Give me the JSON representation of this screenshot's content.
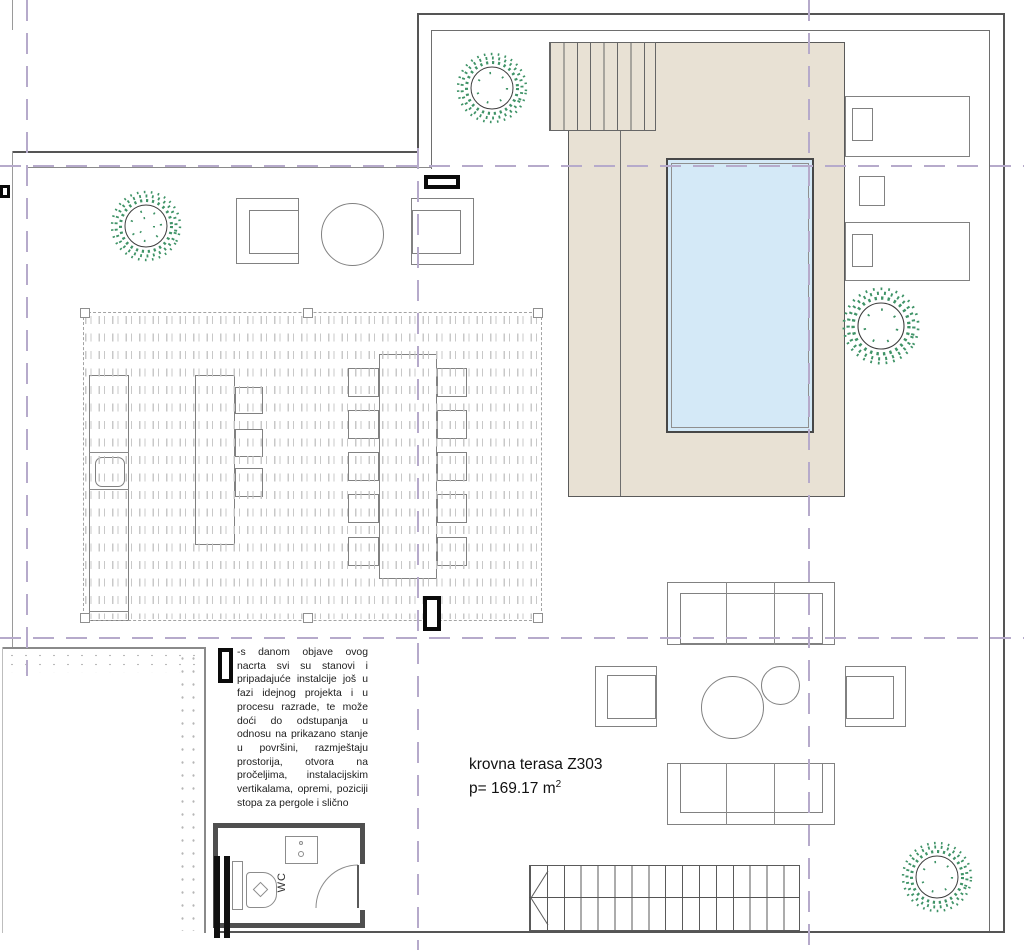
{
  "labels": {
    "room_title": "krovna terasa Z303",
    "room_area": "p= 169.17 m",
    "room_area_sup": "2",
    "wc": "WC",
    "note": "-s danom objave ovog nacrta svi su stanovi i pripadajuće instalcije još u fazi idejnog projekta i u procesu razrade, te može doći do odstupanja u odnosu na prikazano stanje u površini, razmještaju prostorija, otvora na pročeljima, instalacijskim vertikalama, opremi, poziciji stopa za pergole i slično"
  },
  "colors": {
    "deck": "#e8e1d4",
    "pool": "#d4e9f7",
    "axis": "#b6aacb",
    "line": "#555555",
    "line_light": "#8a8a8a",
    "tree": "#3f9367",
    "hatch": "#c6c6c6",
    "wall": "#4f4f4f"
  }
}
